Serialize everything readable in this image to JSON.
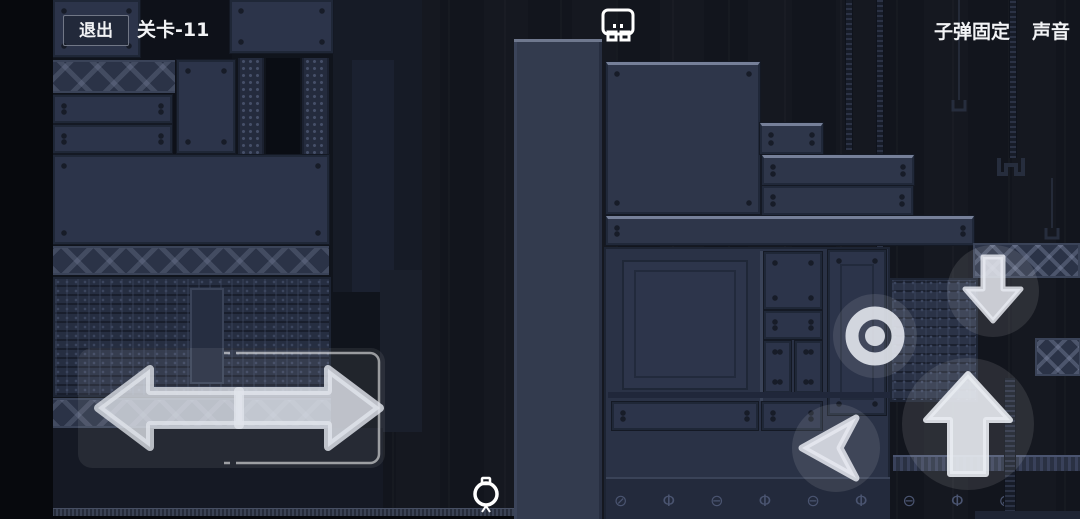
{
  "hud": {
    "exit_button": "退出",
    "level_label": "关卡-11",
    "bullet_fixed_toggle": "子弹固定",
    "sound_toggle": "声音"
  },
  "controls": {
    "move_left": "left-arrow-icon",
    "move_right": "right-arrow-icon",
    "crouch": "down-arrow-icon",
    "jump": "up-arrow-icon",
    "fire": "target-ring-icon",
    "dash": "left-notch-arrow-icon"
  },
  "scene": {
    "screw_row": "⊘ Φ ⊖ Φ ⊖ Φ ⊖ Φ ⊘",
    "player_character": "white-outline-robot",
    "orb_character": "white-outline-orb"
  },
  "colors": {
    "background": "#12151d",
    "panel": "#2c344a",
    "panel_dark": "#272e41",
    "panel_edge_light": "#768099",
    "hud_text": "#f2f3f5",
    "overlay_button": "rgba(255,255,255,0.10)",
    "arrow_icon": "rgba(228,232,238,0.82)"
  }
}
